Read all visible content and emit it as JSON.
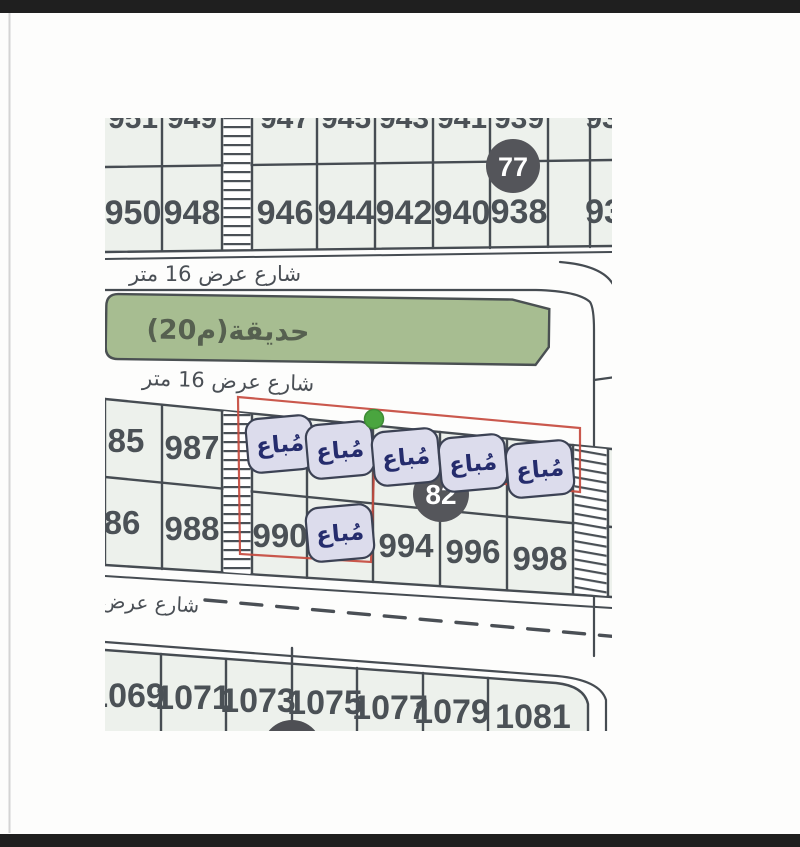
{
  "map": {
    "streets": {
      "top_label": "شارع عرض 16 متر",
      "middle_label": "شارع عرض 16 متر",
      "bottom_label_partial": "شارع عرض"
    },
    "garden": {
      "label": "حديقة(م20)"
    },
    "markers": {
      "m77": "77",
      "m82": "82"
    },
    "sold_label": "مُباع",
    "blocks": {
      "top_back_row": [
        "951",
        "949",
        "947",
        "945",
        "943",
        "941",
        "939",
        "93"
      ],
      "top_front_row": [
        "950",
        "948",
        "946",
        "944",
        "942",
        "940",
        "938",
        "93"
      ],
      "mid_row1": [
        "85",
        "987"
      ],
      "mid_row2": [
        "86",
        "988",
        "990",
        "994",
        "996",
        "998"
      ],
      "bottom_row": [
        "1069",
        "1071",
        "1073",
        "1075",
        "1077",
        "1079",
        "1081"
      ]
    },
    "colors": {
      "line": "#454b52",
      "plot_fill": "#edf1ec",
      "garden_fill": "#a7bd91",
      "sold_badge_bg": "#dcdcec",
      "sold_text": "#252c6d",
      "boundary_red": "#c54a3e",
      "marker_dark": "#54555a",
      "pin_green": "#4aa53f"
    }
  }
}
